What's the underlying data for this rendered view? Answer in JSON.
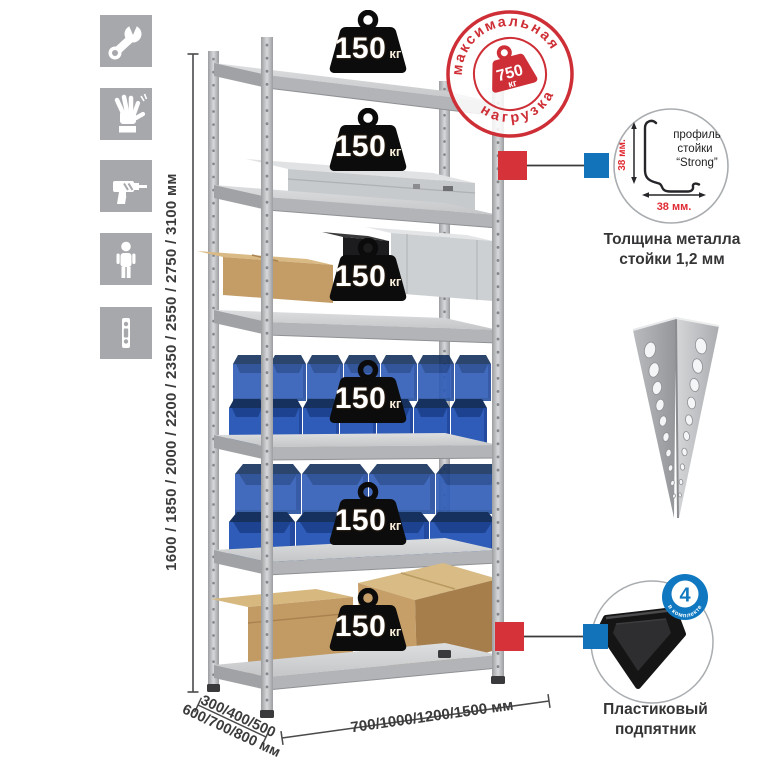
{
  "page": {
    "background": "#ffffff"
  },
  "colors": {
    "accent_red": "#ce2f36",
    "connector_red": "#d6323a",
    "connector_blue": "#1272ba",
    "badge_blue": "#0f78c0",
    "bin_blue": "#2e5cb8",
    "icon_gray": "#a6a8ab",
    "weight_badge_black": "#0c0c0c",
    "dimension_text": "#3b3b3d"
  },
  "tool_icons": [
    {
      "name": "wrench"
    },
    {
      "name": "gloves"
    },
    {
      "name": "drill"
    },
    {
      "name": "person"
    },
    {
      "name": "rack-post"
    }
  ],
  "height_dimension": {
    "label": "1600 / 1850 / 2000 / 2200 / 2350 / 2550 / 2750 / 3100 мм"
  },
  "rack": {
    "shelf_count": 6,
    "shelf_load_value": "150",
    "shelf_load_unit": "кг"
  },
  "max_load_stamp": {
    "arc_top": "максимальная",
    "arc_bottom": "нагрузка",
    "value": "750",
    "unit": "кг"
  },
  "profile_detail": {
    "label_line1": "профиль",
    "label_line2": "стойки",
    "label_line3": "“Strong”",
    "dim_vertical": "38 мм.",
    "dim_horizontal": "38 мм.",
    "caption_line1": "Толщина металла",
    "caption_line2": "стойки 1,2 мм"
  },
  "foot_detail": {
    "badge_value": "4",
    "badge_label": "в комплекте",
    "caption_line1": "Пластиковый",
    "caption_line2": "подпятник"
  },
  "depth_dimension": {
    "line1": "300/400/500",
    "line2": "600/700/800 мм"
  },
  "width_dimension": {
    "label": "700/1000/1200/1500 мм"
  }
}
